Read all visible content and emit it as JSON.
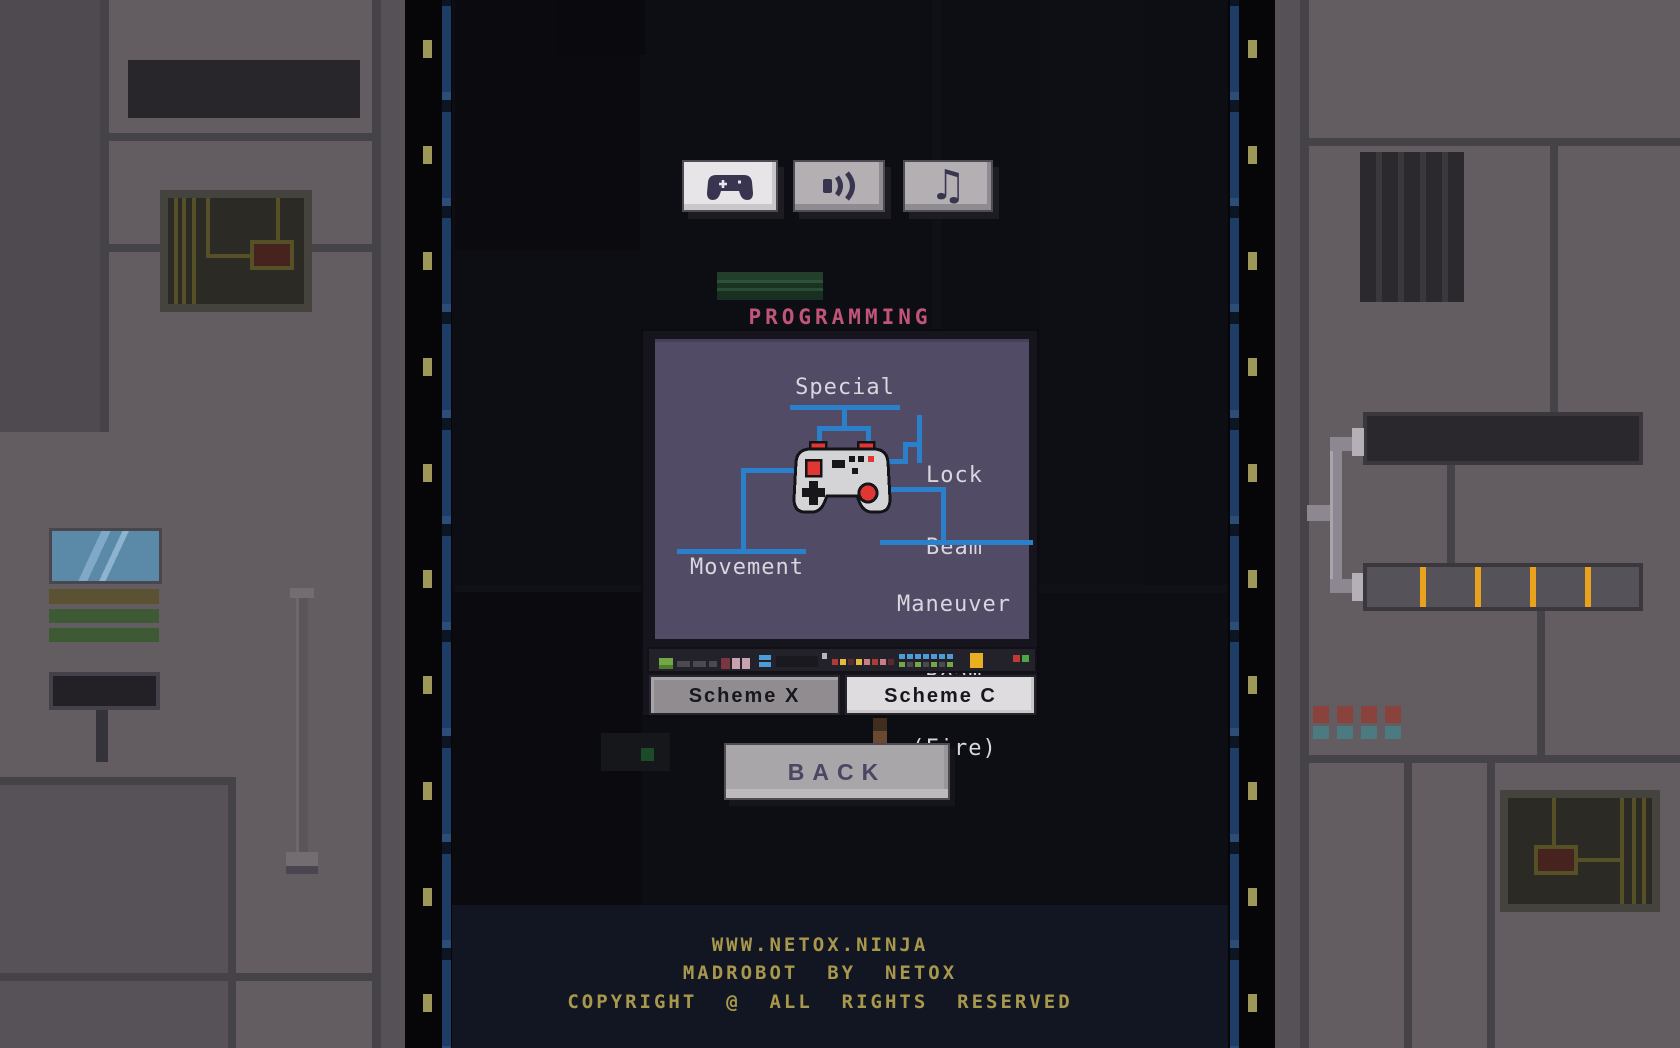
{
  "window": {
    "title": "PROGRAMMING"
  },
  "toolbar": {
    "buttons": [
      {
        "id": "controls",
        "icon": "gamepad-icon",
        "active": true
      },
      {
        "id": "sound",
        "icon": "speaker-icon",
        "active": false
      },
      {
        "id": "music",
        "icon": "music-note-icon",
        "active": false
      }
    ],
    "music_glyph": "♫"
  },
  "diagram": {
    "special": "Special",
    "lock_line1": "Lock",
    "lock_line2": "Beam",
    "movement": "Movement",
    "maneuver_line1": "Maneuver",
    "maneuver_line2": "Beam",
    "maneuver_line3": "(Fire)"
  },
  "schemes": {
    "scheme_x": "Scheme X",
    "scheme_c": "Scheme C",
    "selected": "Scheme C"
  },
  "back": {
    "label": "BACK"
  },
  "footer": {
    "line1": "WWW.NETOX.NINJA",
    "line2": "MADROBOT  BY  NETOX",
    "line3": "COPYRIGHT  @  ALL  RIGHTS  RESERVED"
  },
  "colors": {
    "accent_blue": "#2b80cc",
    "button_red": "#e13632",
    "title_pink": "#c05578",
    "footer_gold": "#a8984c",
    "screen_purple": "#514b66",
    "stripe_orange": "#e8a21e"
  }
}
